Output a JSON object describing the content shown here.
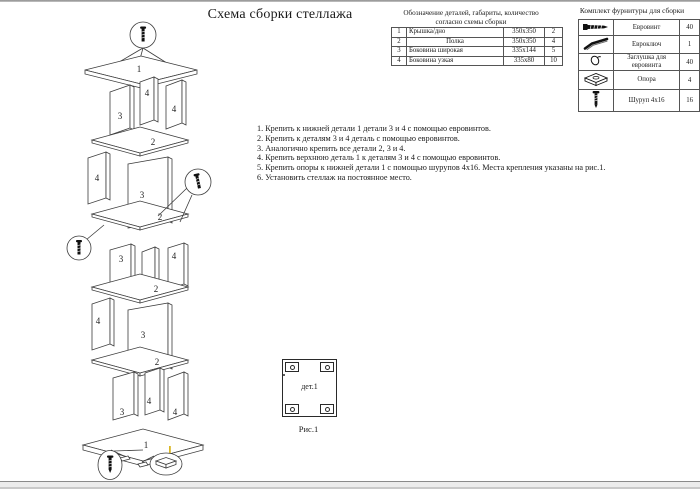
{
  "page": {
    "title": "Схема сборки стеллажа"
  },
  "parts_table": {
    "title_line1": "Обозначение деталей, габариты, количество",
    "title_line2": "согласно схемы сборки",
    "rows": [
      {
        "num": "1",
        "name": "Крышка/дно",
        "size": "350х350",
        "qty": "2"
      },
      {
        "num": "2",
        "name": "Полка",
        "size": "350х350",
        "qty": "4"
      },
      {
        "num": "3",
        "name": "Боковина широкая",
        "size": "335х144",
        "qty": "5"
      },
      {
        "num": "4",
        "name": "Боковина узкая",
        "size": "335х80",
        "qty": "10"
      }
    ]
  },
  "hardware_table": {
    "title": "Комплект фурнитуры для сборки",
    "rows": [
      {
        "icon": "euro-screw-icon",
        "name": "Евровинт",
        "qty": "40"
      },
      {
        "icon": "hex-key-icon",
        "name": "Евроключ",
        "qty": "1"
      },
      {
        "icon": "plug-icon",
        "name": "Заглушка для евровинта",
        "qty": "40"
      },
      {
        "icon": "foot-icon",
        "name": "Опора",
        "qty": "4"
      },
      {
        "icon": "screw-icon",
        "name": "Шуруп 4х16",
        "qty": "16"
      }
    ]
  },
  "instructions": [
    "1. Крепить к нижней детали 1 детали 3 и 4 с помощью евровинтов.",
    "2. Крепить к деталям 3 и 4 деталь с помощью евровинтов.",
    "3. Аналогично крепить все детали 2, 3 и 4.",
    "4. Крепить верхнюю деталь 1 к деталям 3 и 4 с помощью евровинтов.",
    "5. Крепить опоры к нижней детали 1 с помощью шурупов 4х16. Места крепления указаны на рис.1.",
    "6. Установить стеллаж на постоянное место."
  ],
  "figure1": {
    "part_label": "дет.1",
    "caption": "Рис.1"
  },
  "diagram": {
    "part_numbers": {
      "top_bottom": "1",
      "shelf": "2",
      "side_wide": "3",
      "side_narrow": "4"
    },
    "accent_mark_color": "#d4aa00"
  }
}
